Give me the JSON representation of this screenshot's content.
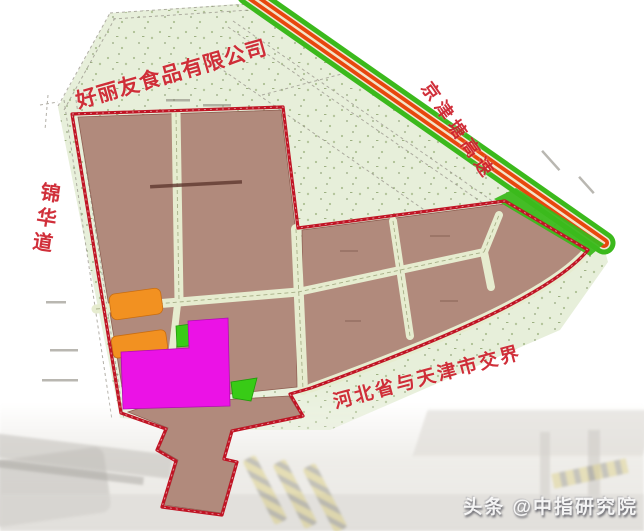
{
  "labels": {
    "company": "好丽友食品有限公司",
    "expressway": "京津塘高速",
    "road_left": "锦华道",
    "boundary": "河北省与天津市交界"
  },
  "watermark": {
    "text": "头条 @中指研究院"
  },
  "colors": {
    "label_red": "#ce222e",
    "boundary_red": "#c01424",
    "parcel_brown": "#b18a7c",
    "parcel_stroke": "#8f5f52",
    "site_green": "#e7efda",
    "highway_green": "#3bb91c",
    "highway_orange": "#e8470e",
    "block_orange": "#f29121",
    "block_magenta": "#eb12e6",
    "block_green": "#38cb16",
    "road_pale": "#e6eccf"
  }
}
